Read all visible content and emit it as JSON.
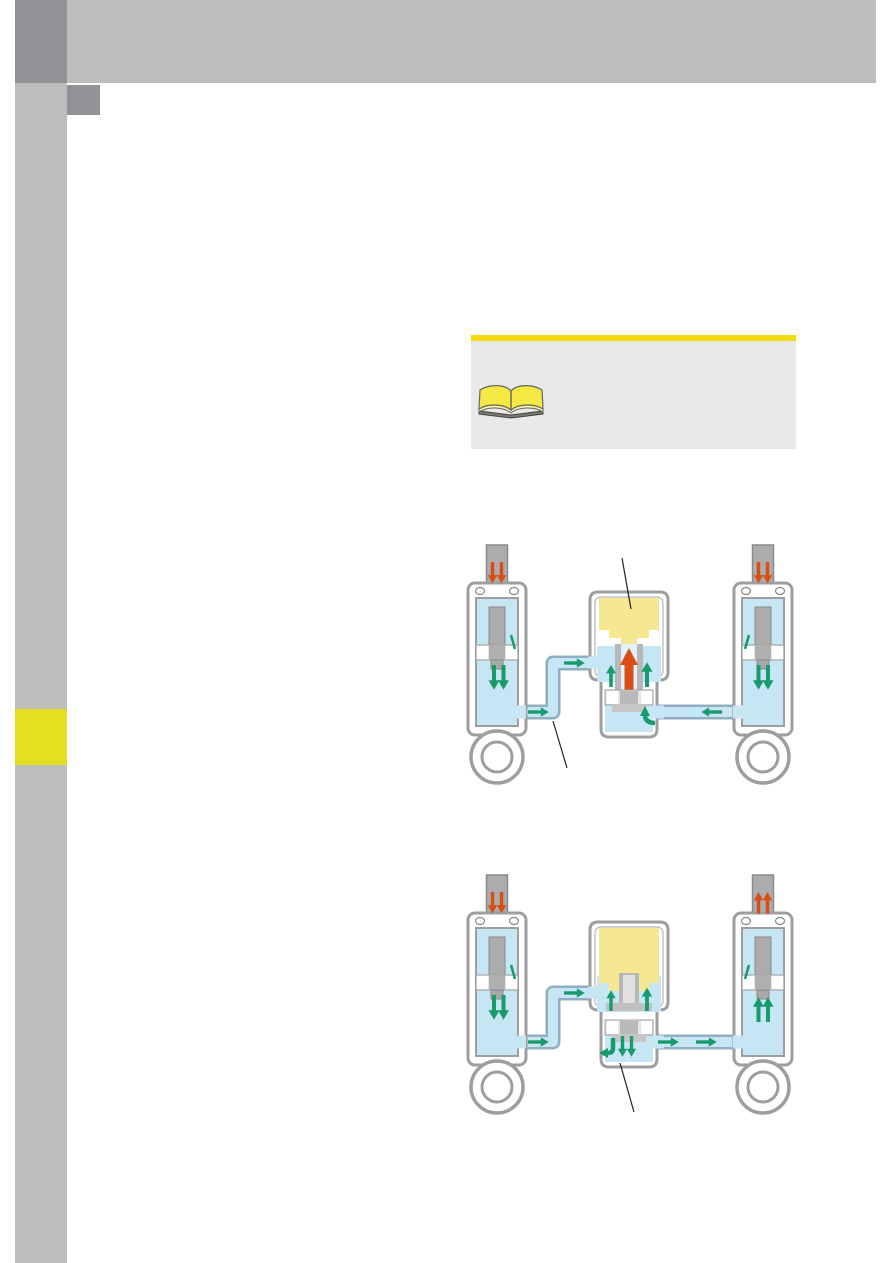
{
  "colors": {
    "gray": "#BDBDBD",
    "darkgray": "#929296",
    "yellowmark": "#E3E01F",
    "infobg": "#E9E9E9",
    "infobar": "#F3DB0B",
    "blue": "#C7E6F4",
    "pipeedge": "#8FAEBF",
    "metal": "#ACACAC",
    "outline": "#9E9EA0",
    "green": "#189A6C",
    "orange": "#D94E15",
    "gas": "#F6E793",
    "ink": "#222222",
    "book": "#F5E943"
  },
  "icons": {
    "infobox": "open-book-icon"
  },
  "figures": [
    {
      "id": "figure-1",
      "callout_count": 2
    },
    {
      "id": "figure-2",
      "callout_count": 1
    }
  ]
}
